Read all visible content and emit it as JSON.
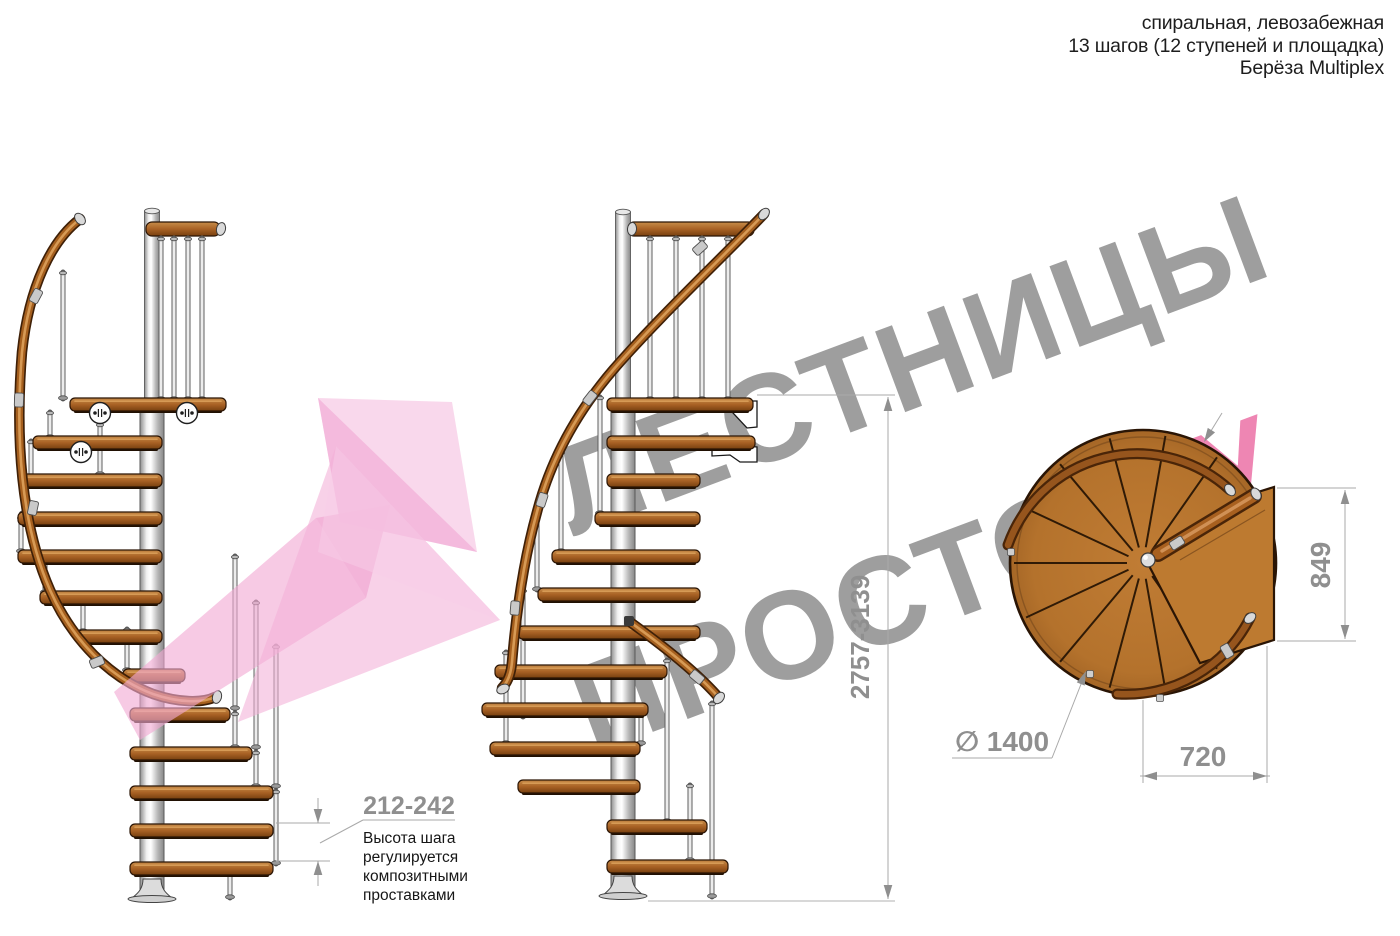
{
  "header": {
    "line1": "спиральная, левозабежная",
    "line2": "13 шагов (12 ступеней и площадка)",
    "line3": "Берёза Multiplex"
  },
  "watermark": {
    "word1": "ЛЕСТНИЦЫ",
    "word2": "ПРОСТО",
    "word3": ".РУ",
    "text_color": "#9e9e9e",
    "accent_color": "#ee86b3",
    "arrow_color": "#f2a9d4"
  },
  "dimensions": {
    "total_height": "2757-3139",
    "platform_depth": "849",
    "platform_width": "720",
    "diameter": "∅ 1400",
    "step_height": "212-242"
  },
  "notes": {
    "step_height_note": [
      "Высота шага",
      "регулируется",
      "композитными",
      "проставками"
    ]
  },
  "colors": {
    "wood": "#a96225",
    "wood_dark": "#7a4012",
    "metal": "#d9d9d9",
    "dimension_gray": "#8f8f8f"
  }
}
